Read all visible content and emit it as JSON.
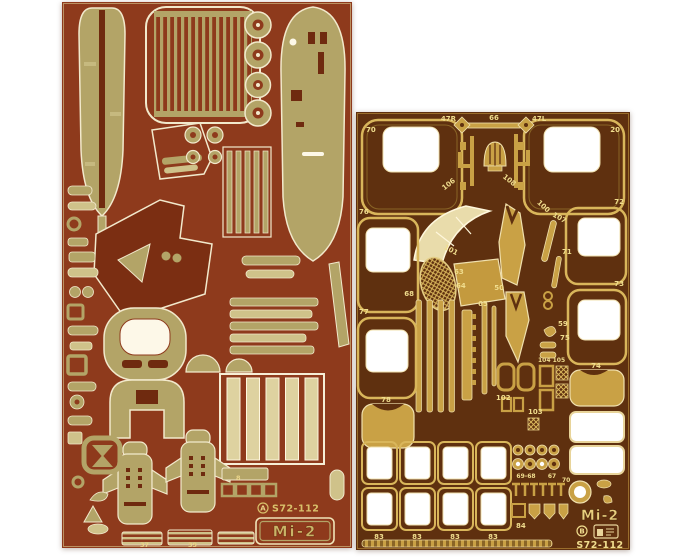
{
  "photo": {
    "alt": "Two photo-etched brass detail frets for a Mi-2 helicopter scale model kit",
    "background": "#ffffff"
  },
  "left_fret": {
    "base_color": "#8e3a1c",
    "part_color": "#b3a467",
    "outline_color": "#f2e9cc",
    "brand_mark": "A",
    "code": "S72-112",
    "model_label": "Mi-2",
    "part_labels": [
      "8",
      "37",
      "39"
    ]
  },
  "right_fret": {
    "base_color": "#5f300f",
    "part_color": "#c9a145",
    "window_cutout_color": "#ffffff",
    "label_color": "#f0dd8e",
    "brand_mark": "B",
    "code": "S72-112",
    "model_label": "Mi-2",
    "part_labels": [
      "70",
      "47R",
      "66",
      "47L",
      "20",
      "106",
      "108",
      "100",
      "107",
      "76",
      "72",
      "101",
      "63",
      "64",
      "68",
      "65",
      "50",
      "77",
      "73",
      "71",
      "59",
      "75",
      "104 105",
      "102",
      "103",
      "78",
      "74",
      "83",
      "83",
      "83",
      "83",
      "69-68",
      "67",
      "70",
      "84"
    ]
  }
}
